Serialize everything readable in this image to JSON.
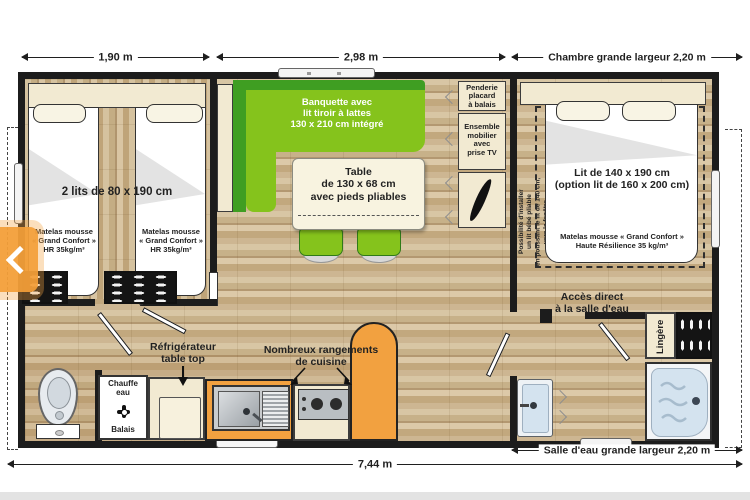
{
  "plan": {
    "dims": {
      "bedroom_left_width": "1,90 m",
      "living_width": "2,98 m",
      "bedroom_right_width": "Chambre grande largeur 2,20 m",
      "bathroom_width": "Salle d'eau grande largeur 2,20 m",
      "total_length": "7,44 m"
    },
    "bedroom_left": {
      "beds_label": "2 lits de 80 x 190 cm",
      "mattress_label": "Matelas mousse\n« Grand Confort »\nHR 35kg/m³"
    },
    "living": {
      "banquette_label": "Banquette avec\nlit tiroir à lattes\n130 x 210 cm intégré",
      "table_label": "Table\nde 130 x 68 cm\navec pieds pliables",
      "wardrobe_label": "Penderie\nplacard\nà balais",
      "tv_unit_label": "Ensemble\nmobilier\navec\nprise TV"
    },
    "bedroom_right": {
      "bed_label": "Lit de 140 x 190 cm\n(option lit de 160 x 200 cm)",
      "mattress_label": "Matelas mousse « Grand Confort »\nHaute Résilience 35 kg/m³",
      "baby_bed_note": "Possibilité d'installer\nun lit bébé pliable\nen poussant le lit de 140 cm,\nvers la fenêtre",
      "bathroom_access_label": "Accès direct\nà la salle d'eau"
    },
    "bathroom": {
      "linen_label": "Lingère"
    },
    "kitchen": {
      "fridge_label": "Réfrigérateur\ntable top",
      "storage_label": "Nombreux rangements\nde cuisine",
      "water_heater_label": "Chauffe\neau",
      "broom_label": "Balais"
    },
    "colors": {
      "wall": "#1c1c1c",
      "banquette_green_dark": "#3f9e22",
      "banquette_green_light": "#85c31c",
      "kitchen_orange": "#f2a140",
      "water_blue": "#d4e3ef"
    }
  }
}
